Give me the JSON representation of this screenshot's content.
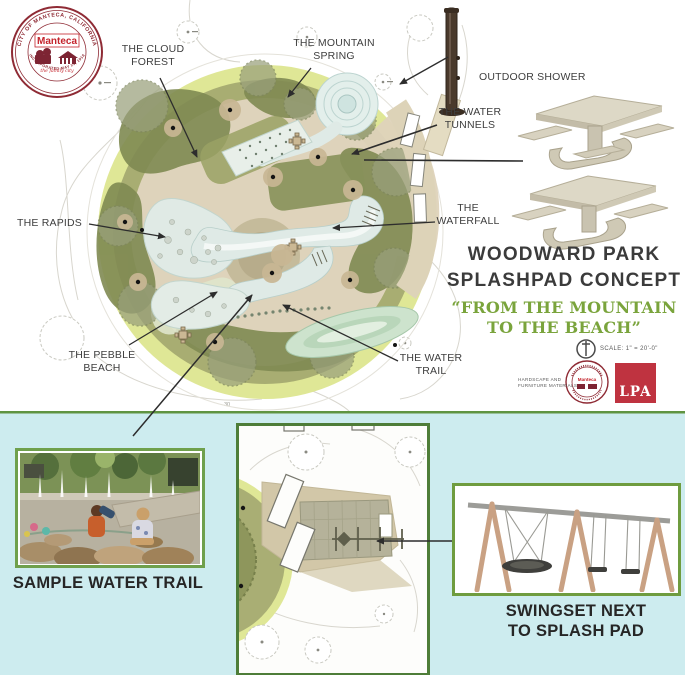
{
  "seal": {
    "arc_top": "CITY OF MANTECA, CALIFORNIA",
    "arc_bottom": "INCORPORATED MAY 25, 1918",
    "name": "Manteca",
    "tagline": "the family city"
  },
  "callouts": {
    "cloud_forest": {
      "line1": "THE CLOUD",
      "line2": "FOREST"
    },
    "mountain_spring": {
      "line1": "THE MOUNTAIN",
      "line2": "SPRING"
    },
    "outdoor_shower": {
      "line1": "OUTDOOR SHOWER"
    },
    "water_tunnels": {
      "line1": "THE WATER",
      "line2": "TUNNELS"
    },
    "waterfall": {
      "line1": "THE",
      "line2": "WATERFALL"
    },
    "rapids": {
      "line1": "THE RAPIDS"
    },
    "pebble_beach": {
      "line1": "THE PEBBLE",
      "line2": "BEACH"
    },
    "water_trail": {
      "line1": "THE WATER",
      "line2": "TRAIL"
    }
  },
  "title": {
    "line1": "WOODWARD PARK",
    "line2": "SPLASHPAD CONCEPT"
  },
  "subtitle": {
    "line1": "“FROM THE MOUNTAIN",
    "line2": "TO THE BEACH”"
  },
  "scale": {
    "label": "SCALE: 1\" = 20'-0\""
  },
  "materials_note": {
    "line1": "HARDSCAPE AND",
    "line2": "FURNITURE MATERIALS"
  },
  "logos": {
    "lpa": "LPA",
    "seal_name": "Manteca"
  },
  "plan": {
    "contour_label": "30"
  },
  "bottom": {
    "sample_caption": "SAMPLE WATER TRAIL",
    "swingset_caption_line1": "SWINGSET NEXT",
    "swingset_caption_line2": "TO SPLASH PAD"
  },
  "colors": {
    "panel_bg": "#cdecef",
    "panel_border_green": "#5f9441",
    "frame_green": "#6fa04c",
    "subtitle_green": "#7aa43c",
    "seal_maroon": "#8f2b35",
    "lpa_red": "#bf3340",
    "plan_tan": "#ded3bb",
    "plan_olive": "#a8ad72",
    "plan_water": "#dfeae6"
  }
}
